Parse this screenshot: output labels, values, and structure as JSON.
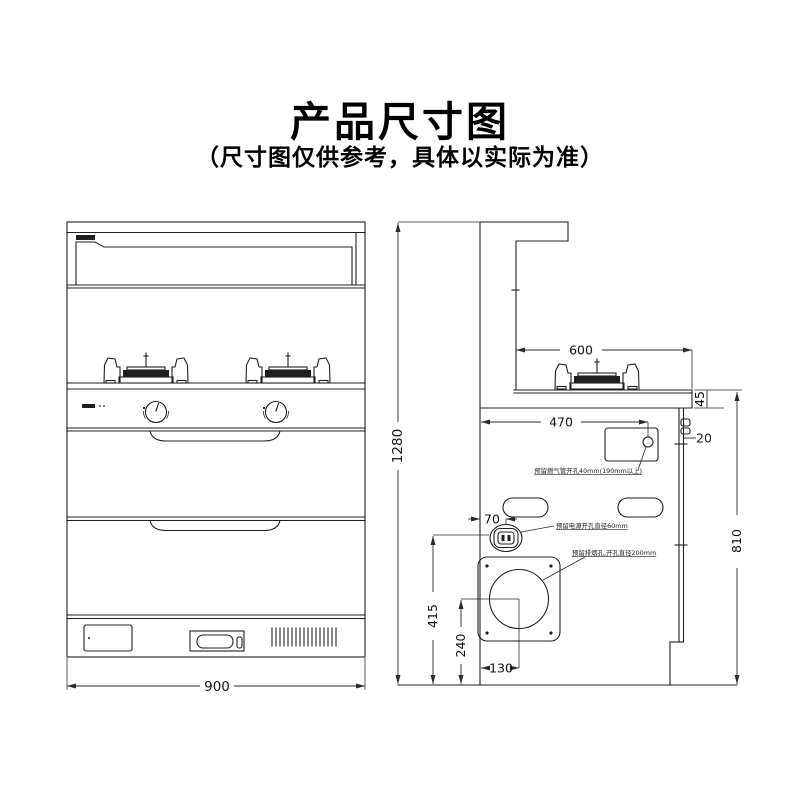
{
  "header": {
    "title": "产品尺寸图",
    "subtitle": "（尺寸图仅供参考，具体以实际为准）"
  },
  "front_view": {
    "width": "900"
  },
  "side_view": {
    "overall_height": "1280",
    "cooktop_depth": "600",
    "cooktop_lip_height": "45",
    "gas_hole_offset_x": "470",
    "bracket_offset": "20",
    "power_hole_offset_x": "70",
    "power_hole_height": "415",
    "flue_center_height": "240",
    "flue_center_offset_x": "130",
    "counter_height": "810",
    "notes": {
      "gas_hole": "预留燃气管开孔40mm(190mm以上)",
      "power_hole": "预留电源开孔直径60mm",
      "flue_hole": "预留排烟孔,开孔直径200mm"
    }
  }
}
